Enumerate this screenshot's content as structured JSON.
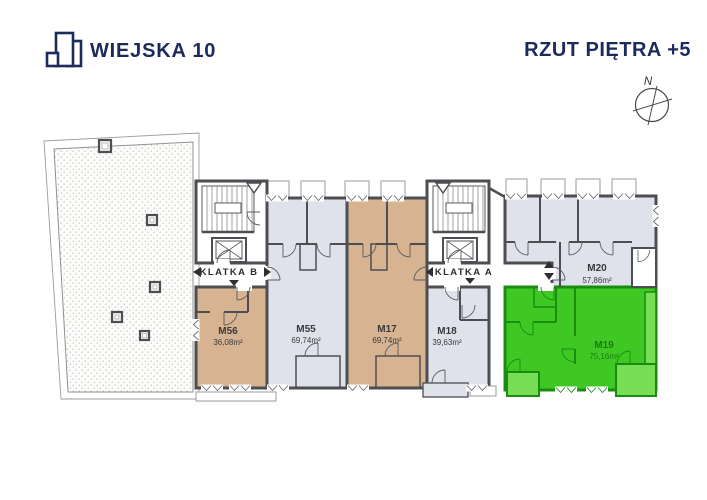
{
  "header": {
    "logo_text": "WIEJSKA 10",
    "title": "RZUT PIĘTRA +5"
  },
  "compass": {
    "label": "N"
  },
  "plan": {
    "staircase_b": "KLATKA B",
    "staircase_a": "KLATKA A",
    "apartments": [
      {
        "id": "M56",
        "area": "36,08m²",
        "fill": "#d7b391",
        "label_color": "#3a3a3c",
        "highlight": "tan"
      },
      {
        "id": "M55",
        "area": "69,74m²",
        "fill": "#dfe2ea",
        "label_color": "#3a3a3c",
        "highlight": "none"
      },
      {
        "id": "M17",
        "area": "69,74m²",
        "fill": "#d7b391",
        "label_color": "#3a3a3c",
        "highlight": "tan"
      },
      {
        "id": "M18",
        "area": "39,63m²",
        "fill": "#dfe2ea",
        "label_color": "#3a3a3c",
        "highlight": "none"
      },
      {
        "id": "M20",
        "area": "57,86m²",
        "fill": "#dfe2ea",
        "label_color": "#3a3a3c",
        "highlight": "none"
      },
      {
        "id": "M19",
        "area": "75,16m²",
        "fill": "#3fc824",
        "label_color": "#1b7d10",
        "highlight": "green"
      }
    ]
  },
  "colors": {
    "brand_navy": "#1c2a5c",
    "wall": "#4c4e52",
    "unit_tan": "#d7b391",
    "unit_gray": "#dfe2ea",
    "unit_green": "#3fc824",
    "unit_green_light": "#77dd55",
    "green_wall": "#1a8c10"
  }
}
